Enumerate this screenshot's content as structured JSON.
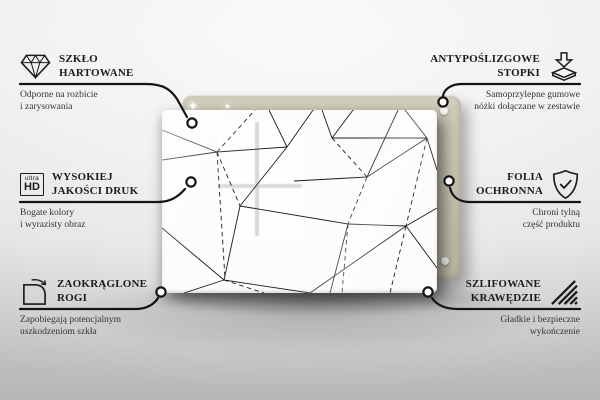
{
  "colors": {
    "board_back": "#c7c3b0",
    "board_back_light": "#d0ccba",
    "glass": "#fcfcfc",
    "pattern_line": "#1b1b1b",
    "callout_line": "#141414",
    "text": "#1c1c1c"
  },
  "features": {
    "left": [
      {
        "icon": "diamond-icon",
        "title_line1": "SZKŁO",
        "title_line2": "HARTOWANE",
        "desc_line1": "Odporne na rozbicie",
        "desc_line2": "i zarysowania"
      },
      {
        "icon": "ultra-hd-icon",
        "icon_text_small": "ultra",
        "icon_text_big": "HD",
        "title_line1": "WYSOKIEJ",
        "title_line2": "JAKOŚCI DRUK",
        "desc_line1": "Bogate kolory",
        "desc_line2": "i wyrazisty obraz"
      },
      {
        "icon": "rounded-corner-icon",
        "title_line1": "ZAOKRĄGLONE",
        "title_line2": "ROGI",
        "desc_line1": "Zapobiegają potencjalnym",
        "desc_line2": "uszkodzeniom szkła"
      }
    ],
    "right": [
      {
        "icon": "anti-slip-feet-icon",
        "title_line1": "ANTYPOŚLIZGOWE",
        "title_line2": "STOPKI",
        "desc_line1": "Samoprzylepne gumowe",
        "desc_line2": "nóżki dołączane w zestawie"
      },
      {
        "icon": "shield-check-icon",
        "title_line1": "FOLIA",
        "title_line2": "OCHRONNA",
        "desc_line1": "Chroni tylną",
        "desc_line2": "część produktu"
      },
      {
        "icon": "polished-edge-icon",
        "title_line1": "SZLIFOWANE",
        "title_line2": "KRAWĘDZIE",
        "desc_line1": "Gładkie i bezpieczne",
        "desc_line2": "wykończenie"
      }
    ]
  },
  "sparkle_glyph": "✦"
}
